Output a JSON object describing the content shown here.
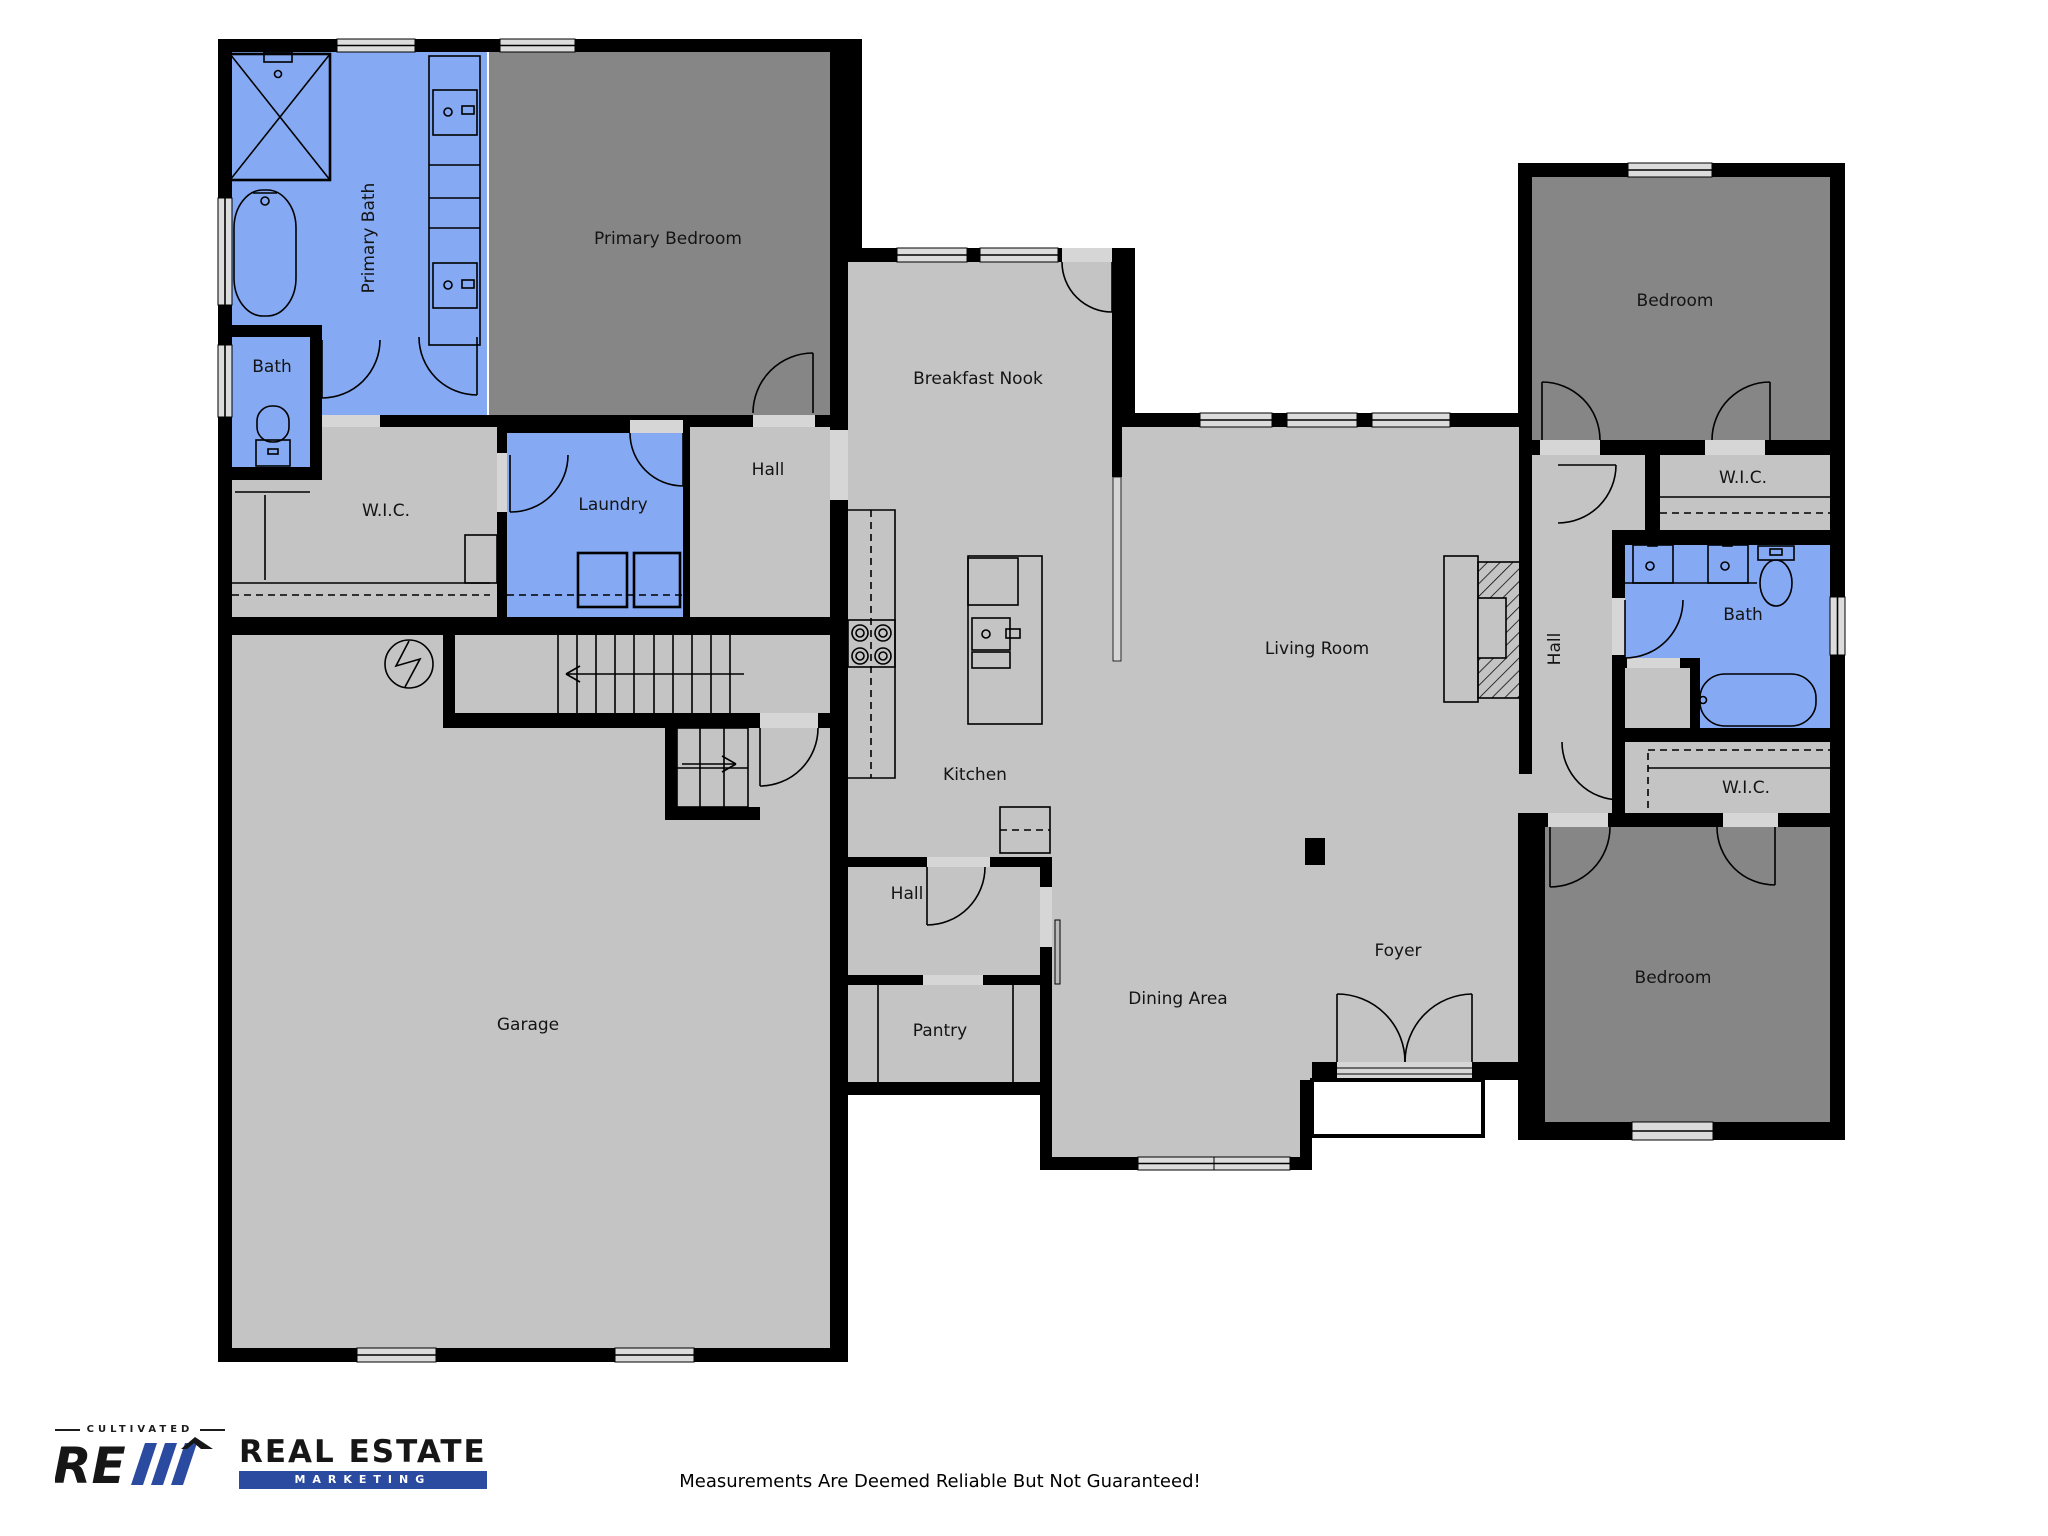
{
  "rooms": {
    "primary_bath": "Primary Bath",
    "primary_bedroom": "Primary Bedroom",
    "bath_left": "Bath",
    "wic_left": "W.I.C.",
    "laundry": "Laundry",
    "hall_upper": "Hall",
    "breakfast_nook": "Breakfast Nook",
    "kitchen": "Kitchen",
    "living_room": "Living Room",
    "hall_lower": "Hall",
    "pantry": "Pantry",
    "dining": "Dining Area",
    "foyer": "Foyer",
    "garage": "Garage",
    "hall_right": "Hall",
    "wic_top_right": "W.I.C.",
    "bath_right": "Bath",
    "wic_bottom_right": "W.I.C.",
    "bedroom_top": "Bedroom",
    "bedroom_bottom": "Bedroom"
  },
  "fixtures": [
    "shower",
    "bathtub",
    "toilet",
    "vanity-sinks",
    "washer",
    "dryer",
    "water-heater",
    "stairs-up",
    "stairs-down",
    "cooktop",
    "kitchen-island",
    "island-sink",
    "dishwasher",
    "refrigerator",
    "fireplace",
    "support-column",
    "entry-double-door",
    "closet-rods",
    "pantry-shelves"
  ],
  "footer": {
    "brand_top": "CULTIVATED",
    "brand_main": "REAL ESTATE",
    "brand_sub": "MARKETING",
    "disclaimer": "Measurements Are Deemed Reliable But Not Guaranteed!"
  },
  "colors": {
    "floor": "#c4c4c4",
    "bedroom": "#868686",
    "bath": "#85aaf3",
    "wall": "#000000",
    "window": "#dcdcdc",
    "threshold": "#d6d6d6",
    "logo_blue": "#2b4ba0",
    "text": "#141414"
  }
}
